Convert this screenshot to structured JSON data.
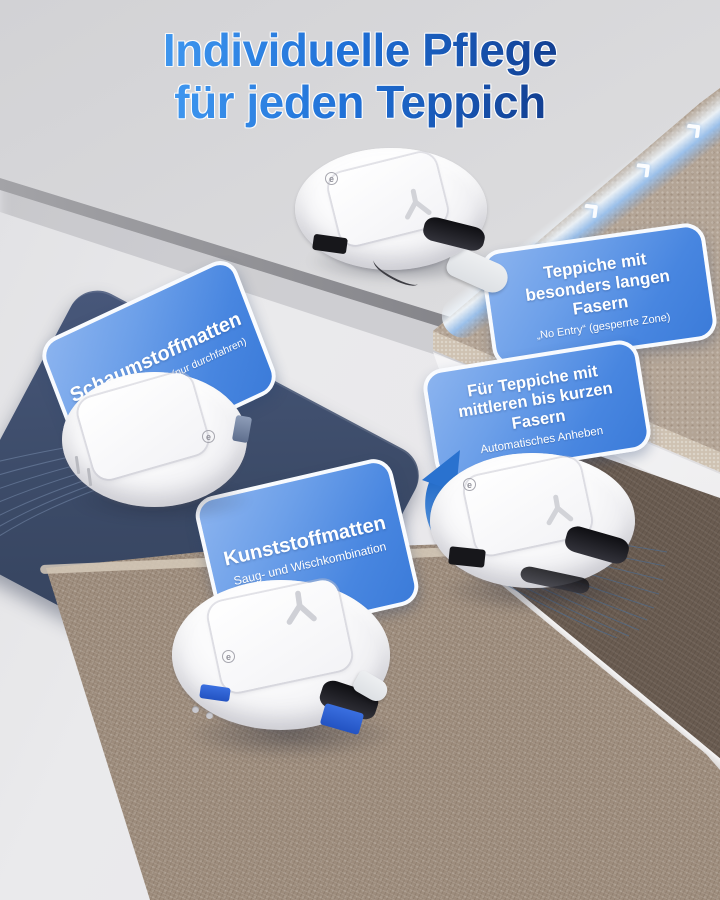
{
  "header": {
    "title_line1": "Individuelle Pflege",
    "title_line2": "für jeden Teppich"
  },
  "callouts": {
    "schaumstoffmatten": {
      "title": "Schaumstoffmatten",
      "subtitle": "„Pass Through Only“ (nur durchfahren)"
    },
    "lange_fasern": {
      "title_line1": "Teppiche mit",
      "title_line2": "besonders langen Fasern",
      "subtitle": "„No Entry“ (gesperrte Zone)"
    },
    "kurze_fasern": {
      "title_line1": "Für Teppiche mit",
      "title_line2": "mittleren bis kurzen Fasern",
      "subtitle": "Automatisches Anheben"
    },
    "kunststoffmatten": {
      "title": "Kunststoffmatten",
      "subtitle": "Saug- und Wischkombination"
    }
  },
  "robot": {
    "logo_letter": "e"
  },
  "colors": {
    "title_blue_light": "#3e96ef",
    "title_blue_dark": "#123f92",
    "callout_blue": "#4886e0",
    "navy_mat": "#3c4b68",
    "carpet_greige": "#b3a495",
    "carpet_dark_brown": "#695b50",
    "carpet_taupe": "#9d8c7c",
    "floor_gray": "#e2e2e5",
    "arrow_blue": "#2a72cf"
  }
}
